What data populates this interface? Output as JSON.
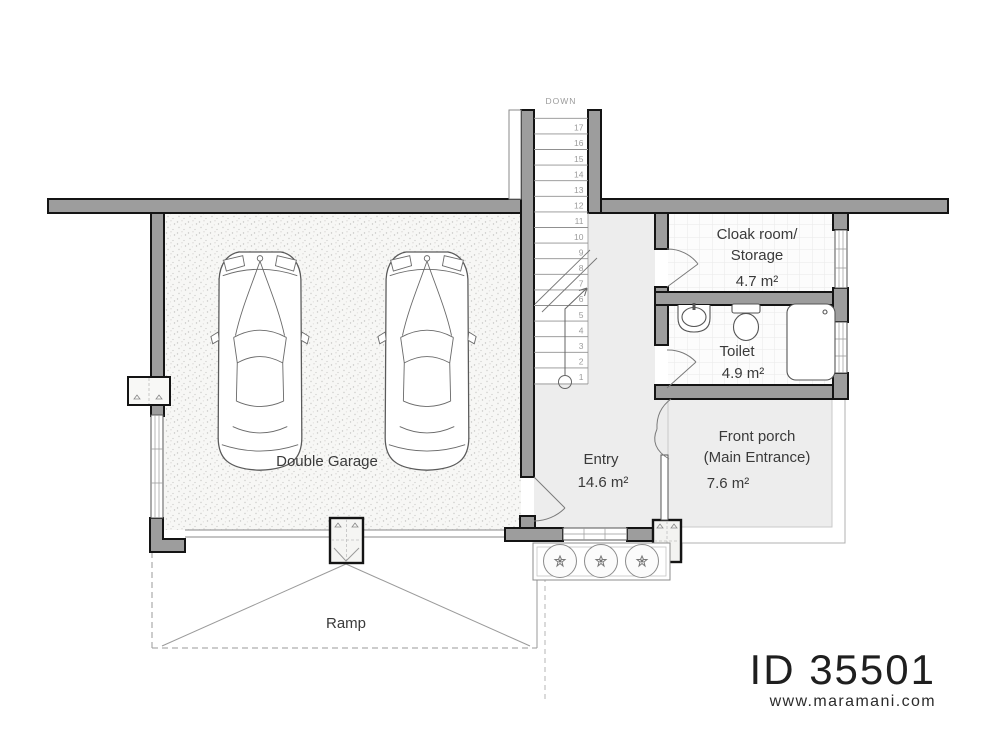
{
  "plan": {
    "rooms": {
      "garage": {
        "name": "Double Garage"
      },
      "entry": {
        "name": "Entry",
        "area": "14.6 m²"
      },
      "cloak": {
        "name1": "Cloak room/",
        "name2": "Storage",
        "area": "4.7 m²"
      },
      "toilet": {
        "name": "Toilet",
        "area": "4.9 m²"
      },
      "porch": {
        "name1": "Front porch",
        "name2": "(Main Entrance)",
        "area": "7.6 m²"
      },
      "ramp": {
        "name": "Ramp"
      }
    },
    "stairs": {
      "label": "DOWN",
      "steps": [
        1,
        2,
        3,
        4,
        5,
        6,
        7,
        8,
        9,
        10,
        11,
        12,
        13,
        14,
        15,
        16,
        17
      ]
    }
  },
  "branding": {
    "plan_id": "ID 35501",
    "website": "www.maramani.com"
  },
  "colors": {
    "wall_fill": "#9d9d9d",
    "wall_outline": "#141414",
    "floor_tint": "#ededed",
    "grid_floor": "#fcfcfc",
    "label_text": "#3a3a3a",
    "muted_text": "#9b9b9b"
  }
}
